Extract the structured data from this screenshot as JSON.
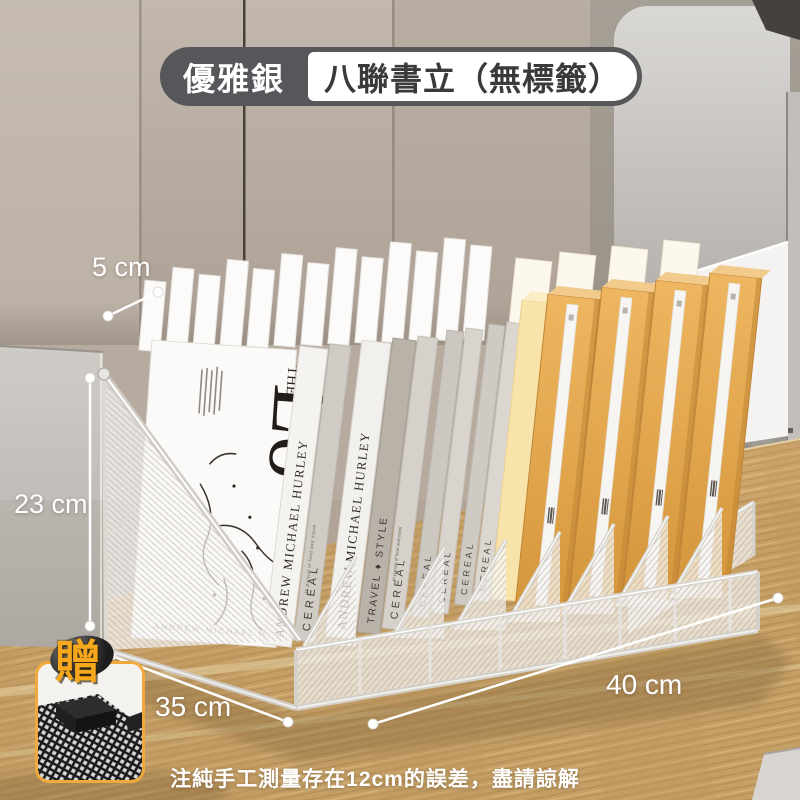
{
  "header_badge": {
    "color_label": "優雅銀",
    "product_label": "八聯書立（無標籤）"
  },
  "measurements": {
    "top": "5 cm",
    "left": "23 cm",
    "bottom_left": "35 cm",
    "bottom_right": "40 cm"
  },
  "gift_badge": "贈",
  "caption": "注純手工測量存在12cm的誤差，盡請諒解",
  "magazine": {
    "masthead_small": "THE",
    "masthead_big": "Lo",
    "byline": "ANDREW MICHAEL HURLEY"
  },
  "spines": [
    {
      "text": "ANDREW MICHAEL HURLEY"
    },
    {
      "text": "CEREAL",
      "subtext": "In pursuit of food and travel"
    },
    {
      "text": "ANDREW MICHAEL HURLEY"
    },
    {
      "text": "TRAVEL ♦ STYLE"
    },
    {
      "text": "CEREAL",
      "subtext": "In pursuit of food and travel"
    },
    {
      "text": "CEREAL"
    },
    {
      "text": "CEREAL"
    },
    {
      "text": "CEREAL"
    },
    {
      "text": "CEREAL"
    }
  ],
  "colors": {
    "accent_orange": "#f2a93b",
    "pill_dark": "#57565a",
    "box_orange": "#e0a44b",
    "desk_wood": "#c9a369",
    "mesh_silver": "#d6d3cd"
  }
}
